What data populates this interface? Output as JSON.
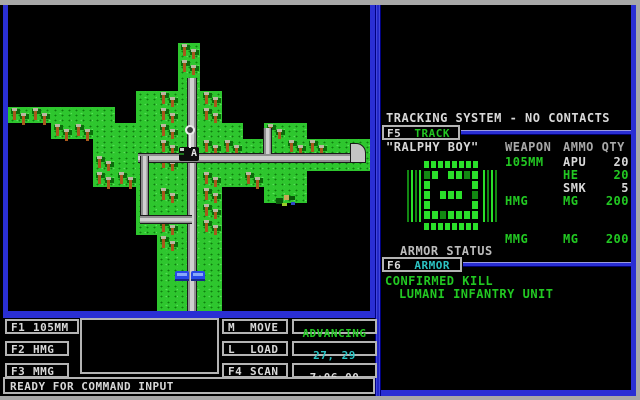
{
  "colors": {
    "border_blue": "#2a2fd4",
    "text_green": "#22c822",
    "text_cyan": "#2cc4c4",
    "text_white": "#d8d8d8",
    "text_gray": "#a8a8a8",
    "grass_green": "#2ec62e",
    "road_gray": "#c4c4c4",
    "unit_blue": "#2848e8"
  },
  "map": {
    "tiles": [
      ".................",
      "........t........",
      "........t........",
      "........g........",
      "......gtgt.......",
      "ttggg.gtgt.......",
      "..ttgggtggg.tg...",
      "....gggtgttggttgg",
      "....tggtggggggggg",
      "....ttgggtgtgg...",
      "......gtgt..gg...",
      "......gggt.......",
      "......gtgt.......",
      ".......tgg.......",
      ".......ggg.......",
      ".......ggg.......",
      ".......ggg.......",
      ".......ggg......."
    ],
    "tile_w": 21.3,
    "tile_h": 16,
    "grid_origin": {
      "x": 0,
      "y": 22
    },
    "roads": [
      {
        "kind": "v",
        "x": 179,
        "y": 73,
        "w": 10,
        "h": 235
      },
      {
        "kind": "h",
        "x": 130,
        "y": 148,
        "w": 218,
        "h": 10
      },
      {
        "kind": "corner",
        "x": 342,
        "y": 138,
        "w": 16,
        "h": 20
      },
      {
        "kind": "v",
        "x": 132,
        "y": 151,
        "w": 9,
        "h": 65
      },
      {
        "kind": "h",
        "x": 132,
        "y": 210,
        "w": 52,
        "h": 9
      },
      {
        "kind": "v",
        "x": 255,
        "y": 123,
        "w": 9,
        "h": 26
      }
    ],
    "units": {
      "cursor": {
        "x": 177,
        "y": 120
      },
      "tank": {
        "x": 171,
        "y": 142,
        "label": "A"
      },
      "vehicle1": {
        "x": 167,
        "y": 266
      },
      "vehicle2": {
        "x": 183,
        "y": 266
      },
      "infantry": {
        "x": 268,
        "y": 188
      }
    }
  },
  "tracking": {
    "status_line": "TRACKING SYSTEM - NO CONTACTS",
    "f5_key": "F5",
    "f5_label": "TRACK",
    "callsign": "\"RALPHY BOY\"",
    "col_weapon": "WEAPON",
    "col_ammo": "AMMO QTY",
    "rows": [
      {
        "weapon": "105MM",
        "weapon_color": "green",
        "ammo": "APU",
        "ammo_color": "white",
        "qty": "20",
        "qty_color": "white",
        "gap_before": false
      },
      {
        "weapon": "",
        "weapon_color": "green",
        "ammo": "HE",
        "ammo_color": "green",
        "qty": "20",
        "qty_color": "green",
        "gap_before": false
      },
      {
        "weapon": "",
        "weapon_color": "green",
        "ammo": "SMK",
        "ammo_color": "white",
        "qty": "5",
        "qty_color": "white",
        "gap_before": false
      },
      {
        "weapon": "HMG",
        "weapon_color": "green",
        "ammo": "MG",
        "ammo_color": "green",
        "qty": "200",
        "qty_color": "green",
        "gap_before": false
      },
      {
        "weapon": "MMG",
        "weapon_color": "green",
        "ammo": "MG",
        "ammo_color": "green",
        "qty": "200",
        "qty_color": "green",
        "gap_before": true
      }
    ]
  },
  "armor": {
    "status_label": "ARMOR STATUS",
    "f6_key": "F6",
    "f6_label": "ARMOR",
    "bar_blocks": 8,
    "body": [
      "##.####",
      "#.....#",
      "#.###.#",
      "#.....#",
      "#######"
    ],
    "kill_line1": "CONFIRMED KILL",
    "kill_line2": "LUMANI INFANTRY UNIT"
  },
  "controls": {
    "weapon_keys": [
      {
        "key": "F1",
        "label": "105MM"
      },
      {
        "key": "F2",
        "label": "HMG"
      },
      {
        "key": "F3",
        "label": "MMG"
      }
    ],
    "command_keys": [
      {
        "key": "M",
        "label": "MOVE"
      },
      {
        "key": "L",
        "label": "LOAD"
      },
      {
        "key": "F4",
        "label": "SCAN"
      }
    ],
    "status_mode": "ADVANCING",
    "status_coords": "27, 29",
    "status_time": "7:06.00",
    "command_bar": "READY FOR COMMAND INPUT"
  }
}
